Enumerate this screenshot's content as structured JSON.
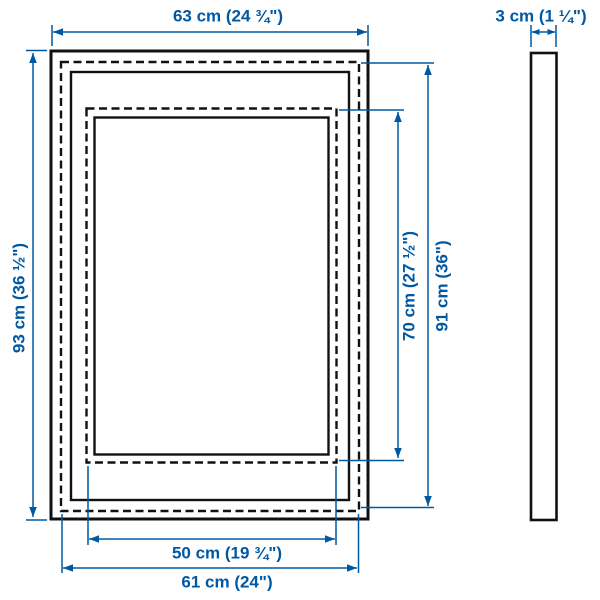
{
  "diagram": {
    "type": "product-dimension-diagram",
    "subject": "picture frame front view with nested picture/mat outlines and side depth profile",
    "colors": {
      "dimension_blue": "#0058a3",
      "outline_black": "#111111",
      "background": "#ffffff"
    },
    "measurements": {
      "top_width": {
        "cm": "63",
        "inches": "24 ¾",
        "label": "63 cm (24 ¾\")"
      },
      "side_depth": {
        "cm": "3",
        "inches": "1 ¼",
        "label": "3 cm (1 ¼\")"
      },
      "left_height": {
        "cm": "93",
        "inches": "36 ½",
        "label": "93 cm (36 ½\")"
      },
      "inner_right_height": {
        "cm": "70",
        "inches": "27 ½",
        "label": "70 cm (27 ½\")"
      },
      "outer_right_height": {
        "cm": "91",
        "inches": "36",
        "label": "91 cm (36\")"
      },
      "inner_bottom_width": {
        "cm": "50",
        "inches": "19 ¾",
        "label": "50 cm (19 ¾\")"
      },
      "outer_bottom_width": {
        "cm": "61",
        "inches": "24",
        "label": "61 cm (24\")"
      }
    }
  }
}
